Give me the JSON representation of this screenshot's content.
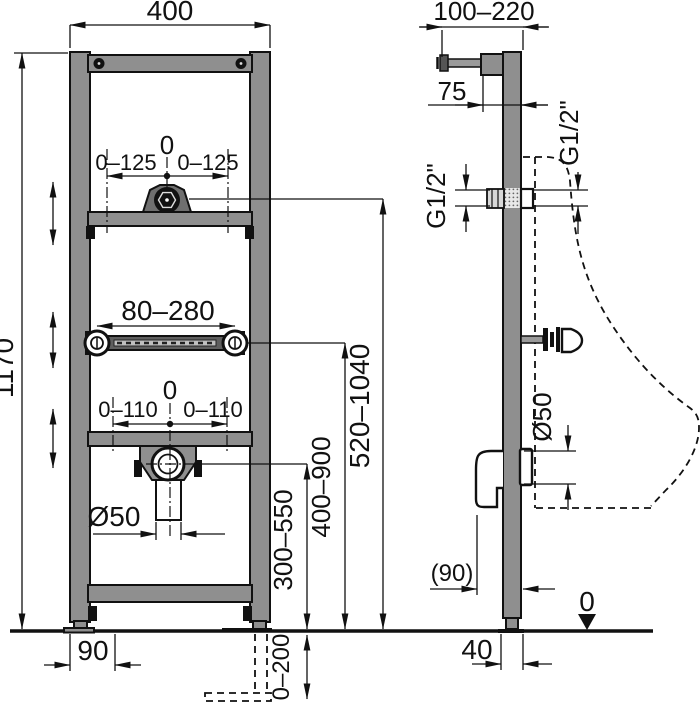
{
  "colors": {
    "line": "#111111",
    "metal_fill": "#8f8f8f",
    "dark_metal_fill": "#6f6f6f",
    "background": "#ffffff"
  },
  "front_view": {
    "frame_width": "400",
    "frame_height": "1170",
    "flush_center": "0",
    "flush_offset_left": "0–125",
    "flush_offset_right": "0–125",
    "mount_rail_span": "80–280",
    "drain_center": "0",
    "drain_offset_left": "0–110",
    "drain_offset_right": "0–110",
    "drain_diameter": "Ø50",
    "foot_offset": "90",
    "drain_height_range": "300–550",
    "rail_height_range": "400–900",
    "flush_height_range": "520–1040",
    "leg_extension_range": "0–200"
  },
  "side_view": {
    "wall_distance_range": "100–220",
    "bracket_depth": "75",
    "water_thread_rear": "G1/2\"",
    "water_thread_front": "G1/2\"",
    "outlet_diameter": "Ø50",
    "outlet_wall_offset": "(90)",
    "floor_datum": "0",
    "profile_depth": "40"
  }
}
